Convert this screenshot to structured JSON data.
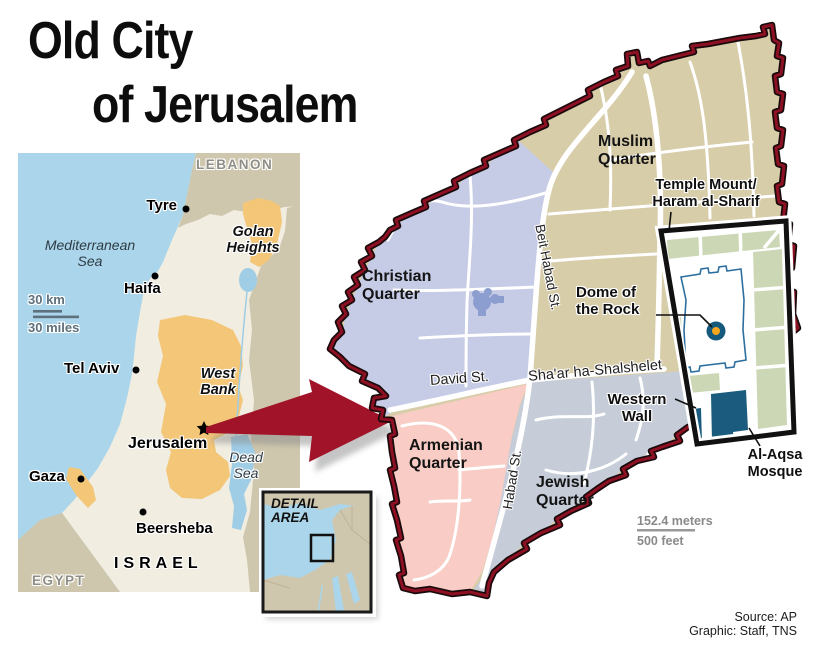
{
  "title": {
    "line1": "Old City",
    "line2": "of Jerusalem"
  },
  "locator": {
    "countries": {
      "lebanon": "LEBANON",
      "jordan": "JORDAN",
      "egypt": "EGYPT",
      "israel": "ISRAEL"
    },
    "regions": {
      "golan": "Golan Heights",
      "west_bank": "West Bank"
    },
    "water": {
      "mediterranean": "Mediterranean Sea",
      "dead_sea": "Dead Sea"
    },
    "cities": {
      "tyre": "Tyre",
      "haifa": "Haifa",
      "tel_aviv": "Tel Aviv",
      "jerusalem": "Jerusalem",
      "gaza": "Gaza",
      "beersheba": "Beersheba"
    },
    "scale": {
      "km": "30 km",
      "miles": "30 miles"
    }
  },
  "detail_inset": {
    "label": "DETAIL AREA"
  },
  "old_city": {
    "quarters": {
      "muslim": "Muslim Quarter",
      "christian": "Christian Quarter",
      "armenian": "Armenian Quarter",
      "jewish": "Jewish Quarter"
    },
    "streets": {
      "beit_habad": "Beit Habad St.",
      "david": "David St.",
      "habad": "Habad St.",
      "shaar": "Sha'ar ha-Shalshelet"
    },
    "landmarks": {
      "temple_mount_1": "Temple Mount/",
      "temple_mount_2": "Haram al-Sharif",
      "dome": "Dome of the Rock",
      "western_wall": "Western Wall",
      "al_aqsa": "Al-Aqsa Mosque"
    },
    "scale": {
      "meters": "152.4 meters",
      "feet": "500 feet"
    }
  },
  "credits": {
    "source": "Source: AP",
    "graphic": "Graphic: Staff, TNS"
  },
  "colors": {
    "sea": "#aad5ea",
    "israel_land": "#f1ede1",
    "neighbor_land": "#cfc7ad",
    "occupied_orange": "#f3c678",
    "wall_maroon": "#8e1023",
    "arrow_red": "#a11328",
    "muslim_tan": "#d8cda9",
    "christian_blue": "#c6cbe6",
    "armenian_pink": "#f9cdc5",
    "jewish_gray": "#c6cdd9",
    "inset_green": "#ccd8b5",
    "mosque_teal": "#1a5b7e",
    "dome_orange": "#f6a61f"
  }
}
